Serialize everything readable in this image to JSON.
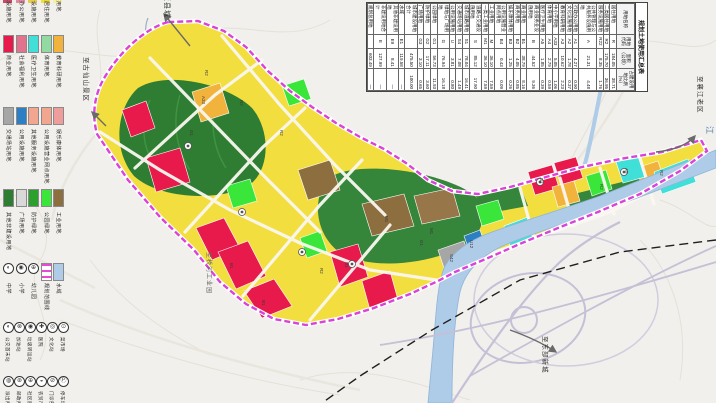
{
  "legend": {
    "cut_row_labels": [
      "文化设施用地",
      "行政办公用地",
      "服务设施用地",
      "二类居住用地",
      "居住用地"
    ],
    "cut_row_colors": [
      "#c84a6a",
      "#e08aa0",
      "#e8cc50",
      "#f2de3f",
      "#f7f0a0"
    ],
    "swatch_rows": [
      {
        "items": [
          {
            "color": "#e8194b",
            "label": "商业用地"
          },
          {
            "color": "#e2738f",
            "label": "社会福利用地"
          },
          {
            "color": "#40e0d8",
            "label": "医疗卫生用地"
          },
          {
            "color": "#93d9a2",
            "label": "体育用地"
          },
          {
            "color": "#f2b33d",
            "label": "教育科研用地"
          }
        ]
      },
      {
        "items": [
          {
            "color": "#a6a6a6",
            "label": "交通场站用地"
          },
          {
            "color": "#2b7fc2",
            "label": "公用设施用地"
          },
          {
            "color": "#f2a58f",
            "label": "其他服务设施用地"
          },
          {
            "color": "#f2a58f",
            "label": "公用设施营业网点用地"
          },
          {
            "color": "#ef9c9c",
            "label": "娱乐康体用地"
          }
        ]
      },
      {
        "items": [
          {
            "color": "#2e7d32",
            "label": "其他非建设用地"
          },
          {
            "color": "#d9d9d9",
            "label": "广场用地"
          },
          {
            "color": "#2ca02c",
            "label": "防护绿地"
          },
          {
            "color": "#39e639",
            "label": "公园绿地"
          },
          {
            "color": "#8d6e3f",
            "label": "工业用地"
          }
        ]
      }
    ],
    "line_row": {
      "circles": [
        {
          "glyph": "◐",
          "label": "中学"
        },
        {
          "glyph": "◉",
          "label": "小学"
        },
        {
          "glyph": "⊕",
          "label": "幼儿园"
        }
      ],
      "boundary": {
        "label": "规划范围线",
        "color": "#e84ad8"
      },
      "water": {
        "label": "水域",
        "color": "#aecbe8"
      }
    },
    "symbol_rows": [
      {
        "items": [
          {
            "glyph": "◐",
            "label": "公交首末站"
          },
          {
            "glyph": "⊗",
            "label": "加油站"
          },
          {
            "glyph": "◉",
            "label": "垃圾转运站"
          },
          {
            "glyph": "✚",
            "label": "医院"
          },
          {
            "glyph": "◎",
            "label": "文化站"
          },
          {
            "glyph": "⊙",
            "label": "菜市场"
          }
        ]
      },
      {
        "items": [
          {
            "glyph": "◍",
            "label": "派出所"
          },
          {
            "glyph": "⊛",
            "label": "邮政所"
          },
          {
            "glyph": "⊕",
            "label": "社区服务站"
          },
          {
            "glyph": "◒",
            "label": "农贸市场"
          },
          {
            "glyph": "⊘",
            "label": "门诊部"
          },
          {
            "glyph": "Ⓟ",
            "label": "停车场"
          }
        ]
      }
    ]
  },
  "summary_table": {
    "title": "规划土地使用汇总表",
    "headers": [
      "用地名称",
      "用地代码",
      "面积（公顷）",
      "占建设用地比例（%）"
    ],
    "rows": [
      [
        "居住用地",
        "R",
        "184.05",
        "38.71"
      ],
      [
        "二类居住用地",
        "R2",
        "175.70",
        "36.95"
      ],
      [
        "服务设施用地",
        "R22",
        "8.35",
        "1.76"
      ],
      [
        "公共管理与公共服务设施用地",
        "A",
        "21.31",
        "4.48"
      ],
      [
        "行政办公用地",
        "A1",
        "4.27",
        "0.90"
      ],
      [
        "文化设施用地",
        "A2",
        "1.78",
        "0.37"
      ],
      [
        "教育科研用地",
        "A3",
        "10.62",
        "2.23"
      ],
      [
        "中小学用地",
        "A33",
        "5.05",
        "1.06"
      ],
      [
        "体育用地",
        "A4",
        "2.79",
        "0.59"
      ],
      [
        "医疗卫生用地",
        "A5",
        "1.85",
        "0.39"
      ],
      [
        "商业服务业设施用地",
        "B",
        "44.52",
        "9.36"
      ],
      [
        "商业用地",
        "B1",
        "38.79",
        "8.16"
      ],
      [
        "商务用地",
        "B2",
        "4.05",
        "0.85"
      ],
      [
        "娱乐康体用地",
        "B3",
        "1.25",
        "0.26"
      ],
      [
        "公用设施营业网点用地",
        "B4",
        "0.43",
        "0.09"
      ],
      [
        "工业用地",
        "M",
        "36.10",
        "7.59"
      ],
      [
        "一类工业用地",
        "M1",
        "36.10",
        "7.59"
      ],
      [
        "道路与交通设施用地",
        "S",
        "85.12",
        "17.90"
      ],
      [
        "城市道路用地",
        "S1",
        "78.04",
        "16.41"
      ],
      [
        "交通场站用地",
        "S4",
        "7.08",
        "1.49"
      ],
      [
        "公用设施用地",
        "U",
        "3.81",
        "0.80"
      ],
      [
        "绿地与广场用地",
        "G",
        "76.94",
        "16.18"
      ],
      [
        "公园绿地",
        "G1",
        "56.73",
        "11.93"
      ],
      [
        "防护绿地",
        "G2",
        "17.11",
        "3.60"
      ],
      [
        "广场用地",
        "G3",
        "3.10",
        "0.65"
      ],
      [
        "城市建设用地合计",
        "",
        "475.50",
        "100.00"
      ],
      [
        "水域",
        "E1",
        "119.58",
        "—"
      ],
      [
        "其他非建设用地",
        "E9",
        "8.41",
        "—"
      ],
      [
        "非建设用地合计",
        "E",
        "127.99",
        "—"
      ],
      [
        "规划总用地",
        "",
        "603.49",
        "—"
      ]
    ]
  },
  "map": {
    "edge_labels": {
      "to_county": "至县城",
      "to_guxianshan": "至古仙山景区",
      "to_xiangjiang_old": "至襄江老区",
      "to_east_newtown": "至东部新城",
      "to_qiaohe_industrial": "至桥河工业园",
      "river": "江"
    },
    "parcel_codes": [
      "R2",
      "R2",
      "R2",
      "A33",
      "B1",
      "B1",
      "M1",
      "M1",
      "G1",
      "R2",
      "B1",
      "A5",
      "R2",
      "G1",
      "S42",
      "R2",
      "U12",
      "B1"
    ]
  },
  "colors": {
    "boundary": "#d943d9",
    "residential": "#f2de3f",
    "commercial": "#e8194b",
    "industry": "#8d6e3f",
    "park": "#39e639",
    "hill_green": "#2e7d32",
    "water": "#aecbe8",
    "education": "#f2b33d",
    "medical": "#40e0d8"
  }
}
